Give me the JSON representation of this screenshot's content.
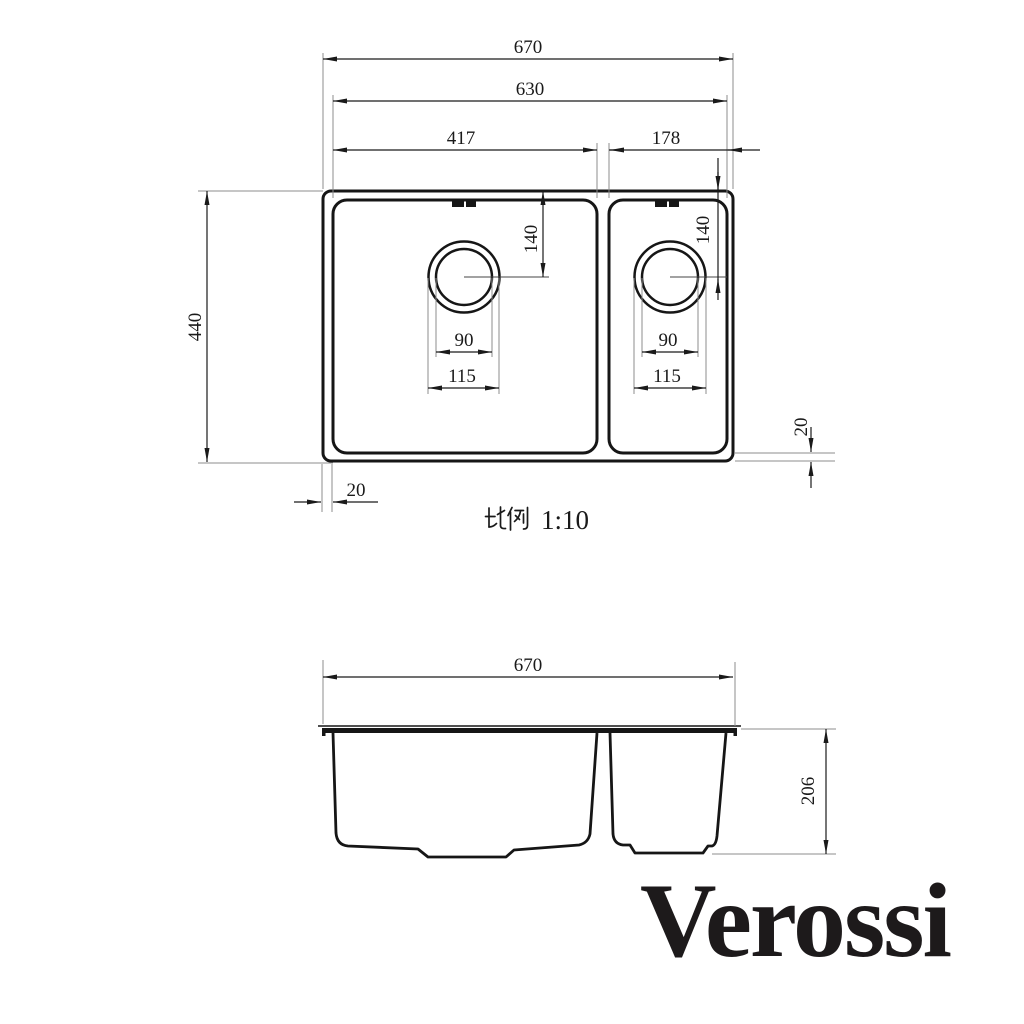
{
  "brand": {
    "logo": "Verossi"
  },
  "scale": {
    "label_cjk": "比例",
    "ratio": "1:10"
  },
  "top_view": {
    "overall_width": "670",
    "inner_width": "630",
    "main_bowl_width": "417",
    "second_bowl_width": "178",
    "overall_depth": "440",
    "main_drain_offset": "140",
    "second_drain_offset": "140",
    "main_drain_inner_dia": "90",
    "main_drain_outer_dia": "115",
    "second_drain_inner_dia": "90",
    "second_drain_outer_dia": "115",
    "side_rim": "20",
    "bottom_rim": "20"
  },
  "side_view": {
    "overall_width": "670",
    "depth": "206"
  }
}
